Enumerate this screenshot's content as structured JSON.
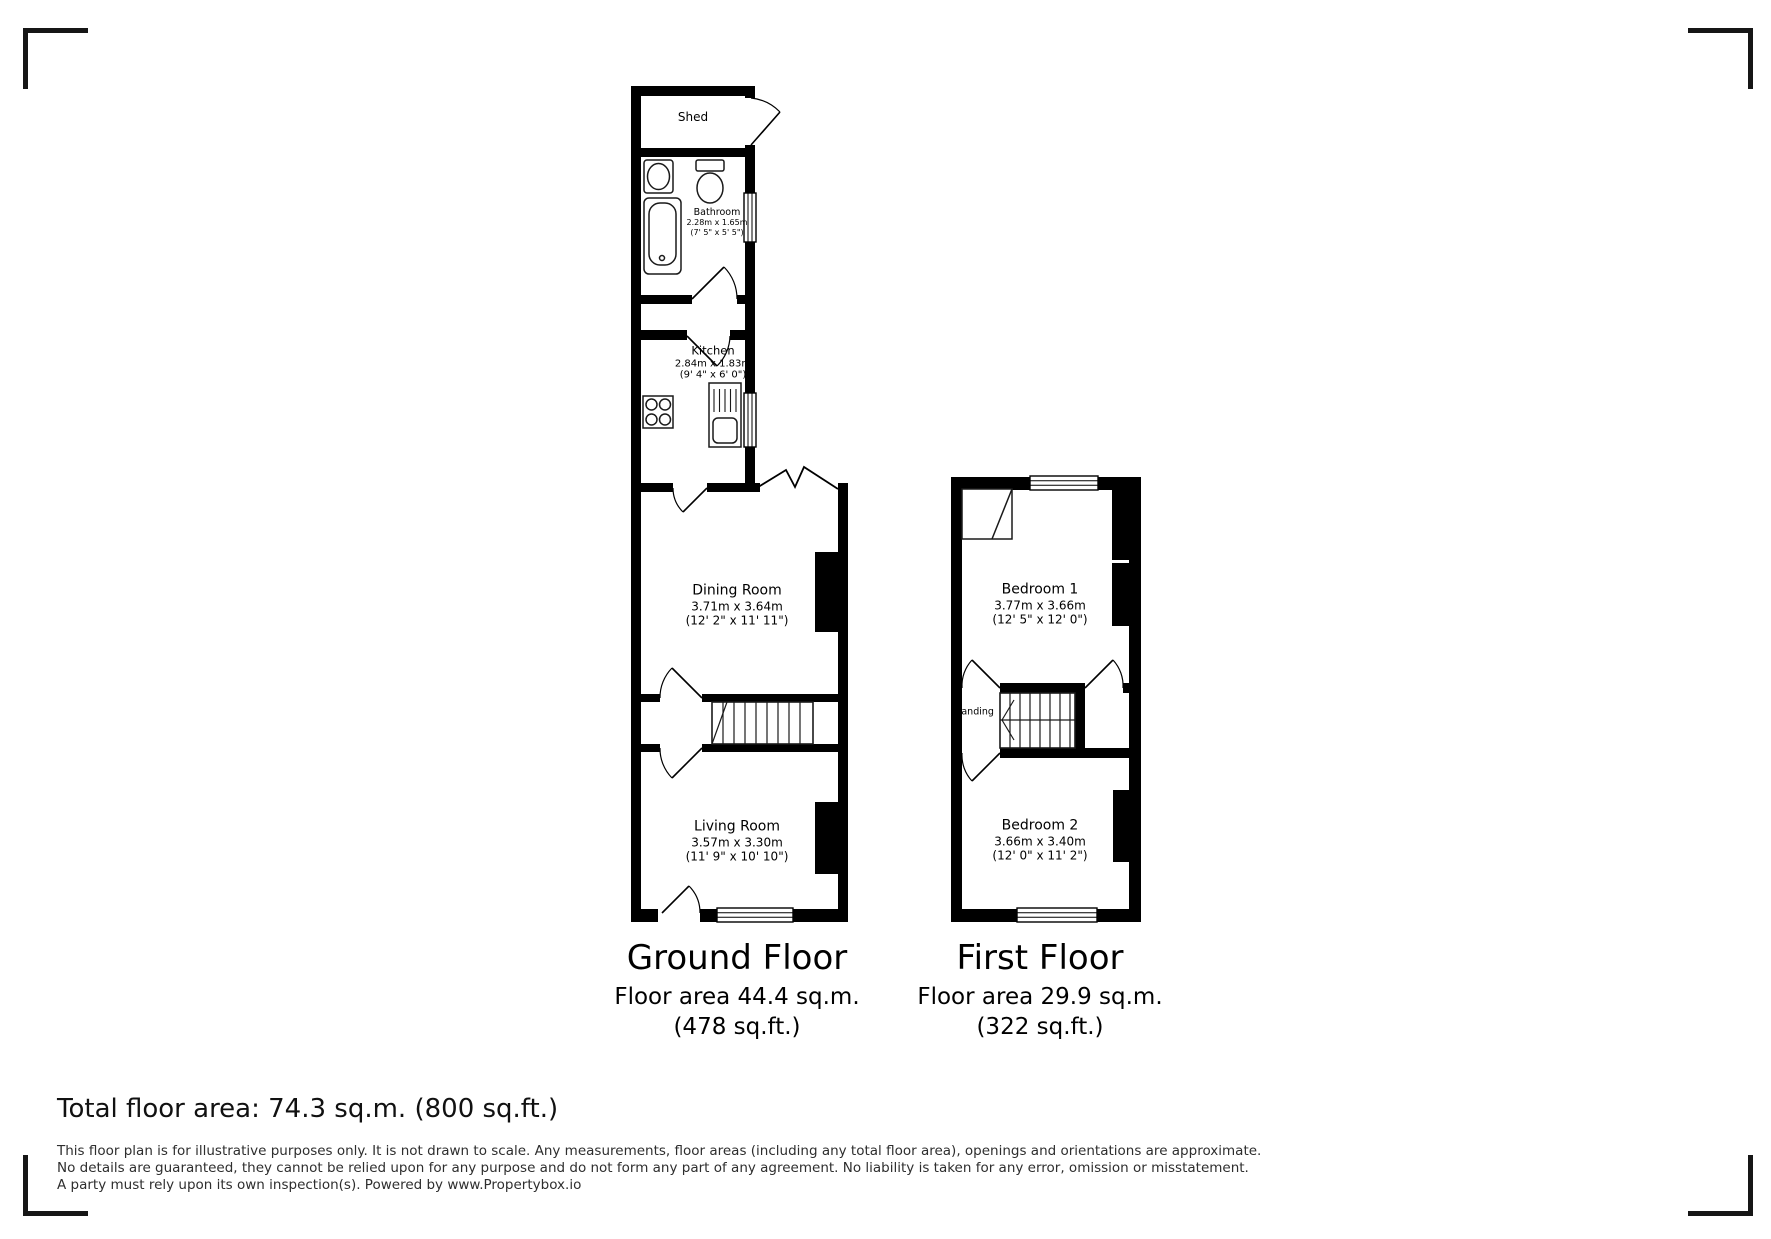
{
  "ground_floor": {
    "title": "Ground Floor",
    "area_line1": "Floor area 44.4 sq.m.",
    "area_line2": "(478 sq.ft.)",
    "rooms": {
      "shed": {
        "name": "Shed"
      },
      "bathroom": {
        "name": "Bathroom",
        "dims_m": "2.28m x 1.65m",
        "dims_ft": "(7' 5\" x 5' 5\")"
      },
      "kitchen": {
        "name": "Kitchen",
        "dims_m": "2.84m x 1.83m",
        "dims_ft": "(9' 4\" x 6' 0\")"
      },
      "dining_room": {
        "name": "Dining Room",
        "dims_m": "3.71m x 3.64m",
        "dims_ft": "(12' 2\" x 11' 11\")"
      },
      "living_room": {
        "name": "Living Room",
        "dims_m": "3.57m x 3.30m",
        "dims_ft": "(11' 9\" x 10' 10\")"
      }
    }
  },
  "first_floor": {
    "title": "First Floor",
    "area_line1": "Floor area 29.9 sq.m.",
    "area_line2": "(322 sq.ft.)",
    "rooms": {
      "bedroom1": {
        "name": "Bedroom 1",
        "dims_m": "3.77m x 3.66m",
        "dims_ft": "(12' 5\" x 12' 0\")"
      },
      "bedroom2": {
        "name": "Bedroom 2",
        "dims_m": "3.66m x 3.40m",
        "dims_ft": "(12' 0\" x 11' 2\")"
      },
      "landing": {
        "name": "Landing"
      }
    }
  },
  "footer": {
    "total_area": "Total floor area: 74.3 sq.m. (800 sq.ft.)",
    "disclaimer": "This floor plan is for illustrative purposes only. It is not drawn to scale. Any measurements, floor areas (including any total floor area), openings and orientations are approximate. No details are guaranteed, they cannot be relied upon for any purpose and do not form any part of any agreement. No liability is taken for any error, omission or misstatement. A party must rely upon its own inspection(s). Powered by www.Propertybox.io"
  },
  "colors": {
    "wall": "#000000",
    "fixture_stroke": "#1a1a1a",
    "disclaimer_text": "#2e2e2e"
  }
}
